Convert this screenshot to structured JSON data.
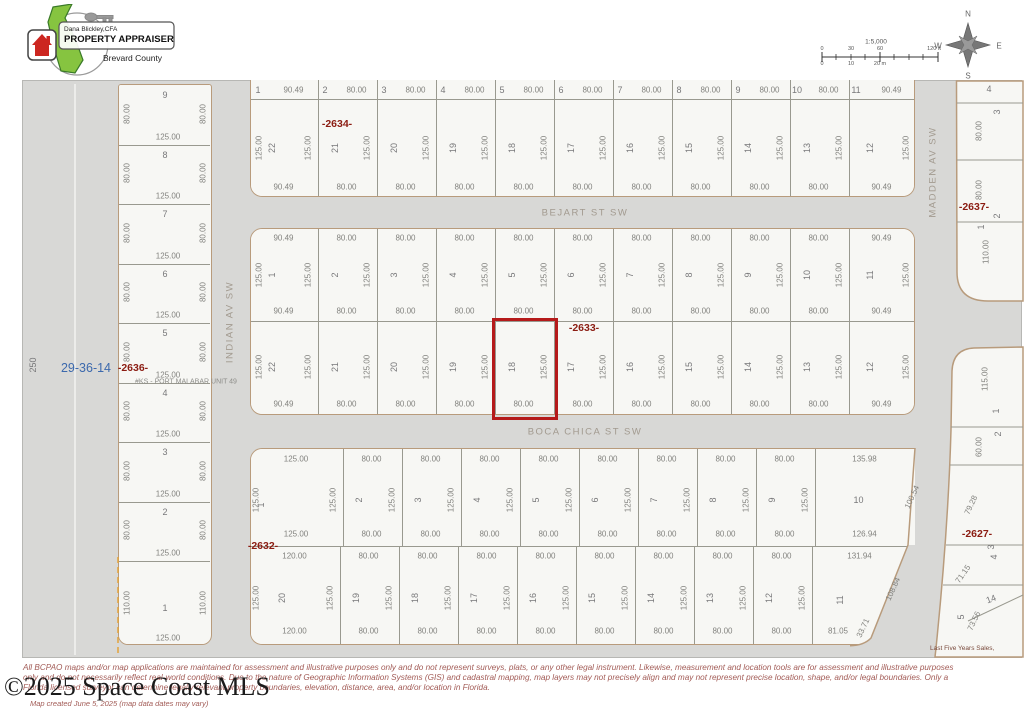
{
  "header": {
    "logo": {
      "name": "Dana Blickley,CFA",
      "title": "PROPERTY APPRAISER",
      "county": "Brevard County"
    },
    "scale": {
      "ratio": "1:5,000",
      "ft_labels": [
        "0",
        "30",
        "60",
        "120 ft"
      ],
      "m_labels": [
        "0",
        "10",
        "20 m"
      ]
    },
    "compass": {
      "n": "N",
      "e": "E",
      "s": "S",
      "w": "W"
    }
  },
  "map": {
    "section_label": "29-36-14",
    "left_road_dim": "250",
    "plat_note": "#KS - PORT MALABAR UNIT 49",
    "streets": {
      "bejart": "BEJART ST SW",
      "boca_chica": "BOCA CHICA ST SW",
      "indian": "INDIAN AV SW",
      "madden": "MADDEN AV SW"
    },
    "highlight": {
      "block": "2633",
      "lot": "18",
      "color": "#b51a1a"
    },
    "blocks": {
      "b2634": {
        "label": "-2634-",
        "row1": {
          "nums": [
            "1",
            "2",
            "3",
            "4",
            "5",
            "6",
            "7",
            "8",
            "9",
            "10",
            "11"
          ],
          "dims": [
            "90.49",
            "80.00",
            "80.00",
            "80.00",
            "80.00",
            "80.00",
            "80.00",
            "80.00",
            "80.00",
            "80.00",
            "90.49"
          ]
        },
        "row2": {
          "nums": [
            "22",
            "21",
            "20",
            "19",
            "18",
            "17",
            "16",
            "15",
            "14",
            "13",
            "12"
          ],
          "side": "125.00",
          "bottoms": [
            "90.49",
            "80.00",
            "80.00",
            "80.00",
            "80.00",
            "80.00",
            "80.00",
            "80.00",
            "80.00",
            "80.00",
            "90.49"
          ]
        }
      },
      "b2633": {
        "label": "-2633-",
        "row1": {
          "nums": [
            "1",
            "2",
            "3",
            "4",
            "5",
            "6",
            "7",
            "8",
            "9",
            "10",
            "11"
          ],
          "tops": [
            "90.49",
            "80.00",
            "80.00",
            "80.00",
            "80.00",
            "80.00",
            "80.00",
            "80.00",
            "80.00",
            "80.00",
            "90.49"
          ],
          "side": "125.00",
          "bottoms": [
            "90.49",
            "80.00",
            "80.00",
            "80.00",
            "80.00",
            "80.00",
            "80.00",
            "80.00",
            "80.00",
            "80.00",
            "90.49"
          ]
        },
        "row2": {
          "nums": [
            "22",
            "21",
            "20",
            "19",
            "18",
            "17",
            "16",
            "15",
            "14",
            "13",
            "12"
          ],
          "side": "125.00",
          "bottoms": [
            "90.49",
            "80.00",
            "80.00",
            "80.00",
            "80.00",
            "80.00",
            "80.00",
            "80.00",
            "80.00",
            "80.00",
            "90.49"
          ]
        }
      },
      "b2632": {
        "label": "-2632-",
        "row1": {
          "nums": [
            "1",
            "2",
            "3",
            "4",
            "5",
            "6",
            "7",
            "8",
            "9",
            "10"
          ],
          "tops": [
            "125.00",
            "80.00",
            "80.00",
            "80.00",
            "80.00",
            "80.00",
            "80.00",
            "80.00",
            "80.00",
            "135.98"
          ],
          "side": "125.00",
          "bottoms": [
            "125.00",
            "80.00",
            "80.00",
            "80.00",
            "80.00",
            "80.00",
            "80.00",
            "80.00",
            "80.00",
            "126.94"
          ],
          "right_edge": "100.54"
        },
        "row2": {
          "nums": [
            "20",
            "19",
            "18",
            "17",
            "16",
            "15",
            "14",
            "13",
            "12",
            "11"
          ],
          "tops": [
            "120.00",
            "80.00",
            "80.00",
            "80.00",
            "80.00",
            "80.00",
            "80.00",
            "80.00",
            "80.00",
            "131.94"
          ],
          "side": "125.00",
          "bottoms": [
            "120.00",
            "80.00",
            "80.00",
            "80.00",
            "80.00",
            "80.00",
            "80.00",
            "80.00",
            "80.00",
            "81.05"
          ],
          "right_edge": "108.84",
          "corner": "33.71"
        }
      },
      "b2636": {
        "label": "-2636-",
        "lots": [
          {
            "n": "9",
            "side": "80.00",
            "bottom": "125.00"
          },
          {
            "n": "8",
            "side": "80.00",
            "bottom": "125.00"
          },
          {
            "n": "7",
            "side": "80.00",
            "bottom": "125.00"
          },
          {
            "n": "6",
            "side": "80.00",
            "bottom": "125.00"
          },
          {
            "n": "5",
            "side": "80.00",
            "bottom": "125.00"
          },
          {
            "n": "4",
            "side": "80.00",
            "bottom": "125.00"
          },
          {
            "n": "3",
            "side": "80.00",
            "bottom": "125.00"
          },
          {
            "n": "2",
            "side": "80.00",
            "bottom": "125.00"
          },
          {
            "n": "1",
            "side": "110.00",
            "bottom": "125.00"
          }
        ]
      },
      "b2637": {
        "label": "-2637-",
        "lots": [
          {
            "n": "4"
          },
          {
            "n": "3",
            "side": "80.00"
          },
          {
            "n": "2",
            "side": "80.00"
          },
          {
            "n": "1",
            "side": "110.00"
          }
        ]
      },
      "b2627": {
        "label": "-2627-",
        "lots": [
          {
            "n": "1",
            "side": "115.00"
          },
          {
            "n": "2",
            "side": "60.00"
          },
          {
            "n": "3",
            "edge": "79.28"
          },
          {
            "n": "4",
            "edge": "71.15"
          },
          {
            "n": "5",
            "edge": "73.56"
          }
        ],
        "partial_lot": "14"
      }
    }
  },
  "footer": {
    "sales_note": "Last Five Years Sales,",
    "disclaimer1": "All BCPAO maps and/or map applications are maintained for assessment and illustrative purposes only and do not represent surveys, plats, or any other legal instrument. Likewise, measurement and location tools are for assessment and illustrative purposes",
    "disclaimer2": "only and do not necessarily reflect real-world conditions. Due to the nature of Geographic Information Systems (GIS) and cadastral mapping, map layers may not precisely align and may not represent precise location, shape, and/or legal boundaries. Only a",
    "disclaimer3": "Florida licensed surveyor can determine legally relevant property boundaries, elevation, distance, area, and/or location in Florida.",
    "created": "Map created June 5, 2025 (map data dates may vary)",
    "watermark": "©2025 Space Coast MLS"
  }
}
